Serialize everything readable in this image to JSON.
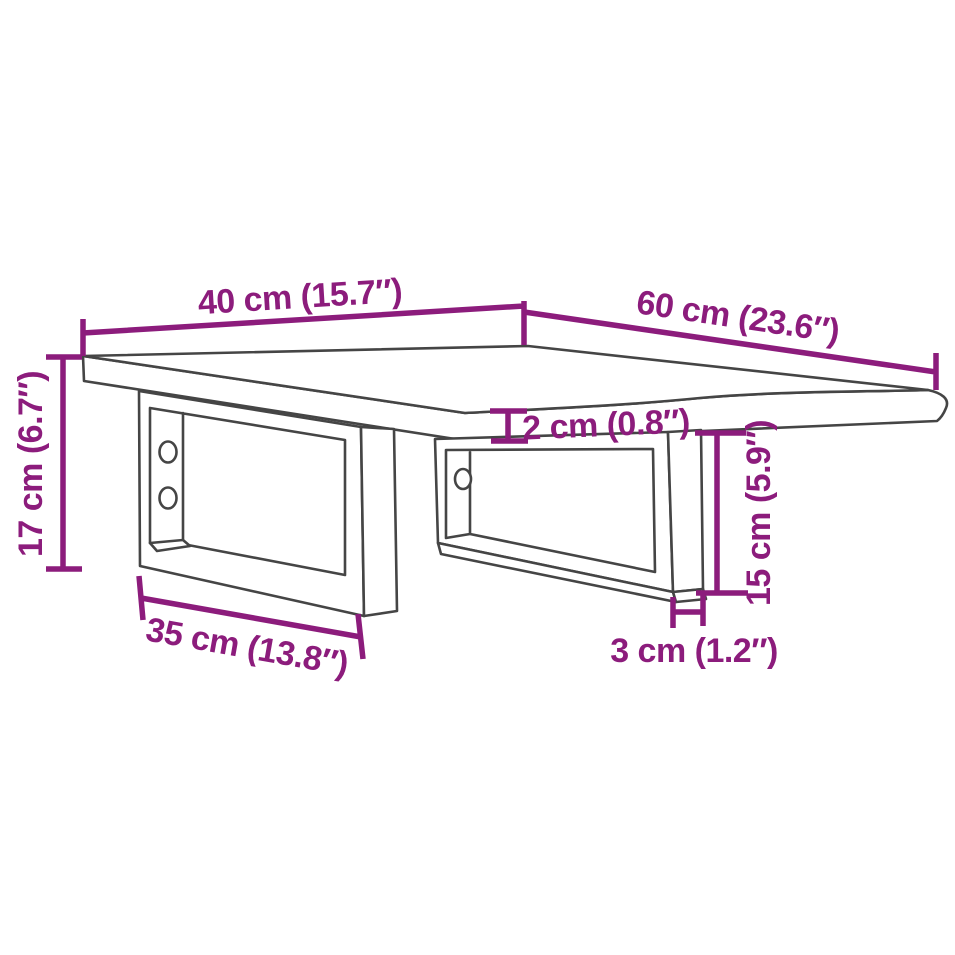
{
  "diagram": {
    "type": "product-dimension-diagram",
    "subject": "wall-mounted shelf top with two u-shaped steel brackets",
    "labels": {
      "top_width": "40 cm (15.7″)",
      "top_depth": "60 cm (23.6″)",
      "overall_height": "17 cm (6.7″)",
      "top_thickness": "2 cm (0.8″)",
      "bracket_height": "15 cm (5.9″)",
      "bracket_depth": "35 cm (13.8″)",
      "bracket_profile": "3 cm (1.2″)"
    },
    "colors": {
      "dimension_accent": "#8C1C7C",
      "outline": "#454545",
      "background": "#FFFFFF"
    }
  }
}
